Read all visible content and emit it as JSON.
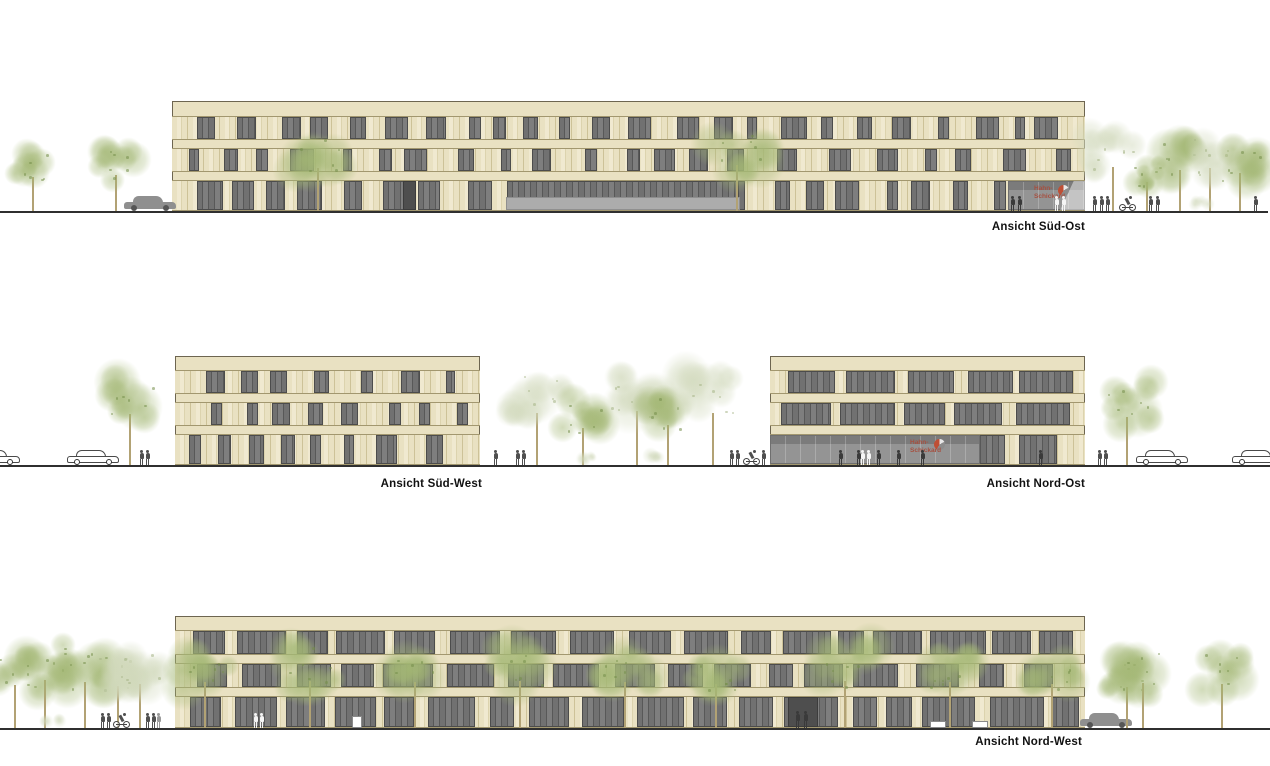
{
  "palette": {
    "background": "#ffffff",
    "wall": "#e9e1c2",
    "wall_stripe_light": "#f0e9d0",
    "wall_stripe_dark": "#dcd3ae",
    "wall_joint": "#cdc298",
    "facade_line": "#a2976f",
    "building_outline": "#6d6550",
    "window_glass": "#717171",
    "window_glass_dark": "#585858",
    "window_glass_light": "#7e7e7e",
    "window_outline": "#4c4c4c",
    "storefront_grey": "#949494",
    "storefront_top": "#7b7b7b",
    "canopy_grey": "#acacac",
    "door_dark": "#4e4e4e",
    "ground_line": "#2f2f2f",
    "figure_grey": "#4f4f4f",
    "figure_dark": "#3a3a3a",
    "figure_white": "#f5f5f5",
    "figure_light": "#9a9a9a",
    "car_outline": "#4a4a4a",
    "car_fill": "#8f8f8f",
    "trunk": "#b2a274",
    "tree_green": [
      163,
      183,
      116
    ],
    "tree_green_dark": [
      116,
      142,
      74
    ],
    "tree_pale": [
      208,
      216,
      186
    ],
    "tree_pale_dark": [
      165,
      180,
      135
    ],
    "logo_red": "#bf4f35",
    "logo_grey": "#8c8c8c",
    "logo_text_color": "#a65040"
  },
  "logo": {
    "line1": "Hahn-",
    "line2": "Schickard"
  },
  "views": {
    "sued_ost": {
      "label": "Ansicht Süd-Ost",
      "ground": {
        "y": 211,
        "x1": 0,
        "x2": 1268
      },
      "building": {
        "x": 172,
        "y": 101,
        "w": 913,
        "parapet_h": 15,
        "band_h": 8,
        "floors": [
          {
            "h": 24,
            "pattern": {
              "edge": 10,
              "gap": [
                8,
                30
              ],
              "win": [
                9,
                26
              ],
              "seed": 11
            }
          },
          {
            "h": 24,
            "pattern": {
              "edge": 14,
              "gap": [
                10,
                34
              ],
              "win": [
                9,
                24
              ],
              "seed": 23
            }
          },
          {
            "h": 31,
            "pattern": {
              "edge": 10,
              "gap": [
                8,
                30
              ],
              "win": [
                9,
                26
              ],
              "seed": 37
            },
            "overlays": [
              {
                "type": "glass",
                "x": 335,
                "w": 232
              },
              {
                "type": "door",
                "x": 231,
                "w": 13
              },
              {
                "type": "storefront",
                "x": 836,
                "w": 77,
                "logo": true,
                "logo_left": 26,
                "diagonal": true,
                "top_band": true
              },
              {
                "type": "canopy",
                "x": 334,
                "w": 234,
                "h": 13
              }
            ]
          }
        ]
      },
      "trees": [
        {
          "x": 33,
          "h": 62,
          "s": 34,
          "tone": "green",
          "seed": 1
        },
        {
          "x": 116,
          "h": 66,
          "s": 38,
          "tone": "green",
          "seed": 2
        },
        {
          "x": 318,
          "h": 78,
          "s": 46,
          "tone": "green",
          "seed": 3
        },
        {
          "x": 737,
          "h": 84,
          "s": 50,
          "tone": "green",
          "seed": 4
        },
        {
          "x": 1113,
          "h": 80,
          "s": 46,
          "tone": "pale",
          "seed": 5
        },
        {
          "x": 1147,
          "h": 52,
          "s": 30,
          "tone": "green",
          "seed": 6
        },
        {
          "x": 1180,
          "h": 74,
          "s": 46,
          "tone": "green",
          "seed": 7
        },
        {
          "x": 1210,
          "h": 78,
          "s": 46,
          "tone": "pale",
          "seed": 8
        },
        {
          "x": 1240,
          "h": 70,
          "s": 44,
          "tone": "green",
          "seed": 9
        }
      ],
      "bushes": [
        {
          "x": 1200,
          "s": 16,
          "seed": 10
        }
      ],
      "cars": [
        {
          "x": 150,
          "style": "solid"
        }
      ],
      "bikes": [
        {
          "x": 1128
        }
      ],
      "figures": [
        {
          "x": 1094
        },
        {
          "x": 1101
        },
        {
          "x": 1107
        },
        {
          "x": 1150
        },
        {
          "x": 1157
        },
        {
          "x": 1255
        },
        {
          "x": 1012,
          "color": "dark"
        },
        {
          "x": 1019,
          "color": "dark"
        },
        {
          "x": 1056,
          "color": "white"
        },
        {
          "x": 1063,
          "color": "white"
        }
      ],
      "boxes": []
    },
    "sued_west": {
      "label": "Ansicht Süd-West",
      "ground": {
        "y": 465,
        "x1": 0,
        "x2": 770
      },
      "building": {
        "x": 175,
        "y": 356,
        "w": 305,
        "parapet_h": 14,
        "band_h": 8,
        "floors": [
          {
            "h": 24,
            "pattern": {
              "edge": 8,
              "gap": [
                10,
                34
              ],
              "win": [
                9,
                22
              ],
              "seed": 5
            }
          },
          {
            "h": 24,
            "pattern": {
              "edge": 12,
              "gap": [
                12,
                36
              ],
              "win": [
                9,
                20
              ],
              "seed": 17
            }
          },
          {
            "h": 31,
            "pattern": {
              "edge": 8,
              "gap": [
                10,
                30
              ],
              "win": [
                10,
                24
              ],
              "seed": 29
            }
          }
        ]
      },
      "trees": [
        {
          "x": 130,
          "h": 92,
          "s": 52,
          "tone": "green",
          "seed": 11
        },
        {
          "x": 537,
          "h": 95,
          "s": 56,
          "tone": "pale",
          "seed": 12
        },
        {
          "x": 583,
          "h": 68,
          "s": 40,
          "tone": "green",
          "seed": 13
        },
        {
          "x": 637,
          "h": 98,
          "s": 58,
          "tone": "pale",
          "seed": 14
        },
        {
          "x": 668,
          "h": 72,
          "s": 42,
          "tone": "green",
          "seed": 15
        },
        {
          "x": 713,
          "h": 95,
          "s": 56,
          "tone": "pale",
          "seed": 16
        }
      ],
      "bushes": [
        {
          "x": 590,
          "s": 15,
          "seed": 17
        },
        {
          "x": 657,
          "s": 15,
          "seed": 18
        }
      ],
      "cars": [
        {
          "x": -6,
          "style": "outline"
        },
        {
          "x": 93,
          "style": "outline"
        }
      ],
      "bikes": [
        {
          "x": 752
        }
      ],
      "figures": [
        {
          "x": 141
        },
        {
          "x": 147
        },
        {
          "x": 495
        },
        {
          "x": 517
        },
        {
          "x": 523
        },
        {
          "x": 731
        },
        {
          "x": 737
        },
        {
          "x": 763
        }
      ],
      "boxes": []
    },
    "nord_ost": {
      "label": "Ansicht Nord-Ost",
      "ground": {
        "y": 465,
        "x1": 770,
        "x2": 1270
      },
      "building": {
        "x": 770,
        "y": 356,
        "w": 315,
        "parapet_h": 14,
        "band_h": 8,
        "floors": [
          {
            "h": 24,
            "pattern": {
              "edge": 6,
              "gap": [
                6,
                14
              ],
              "win": [
                30,
                64
              ],
              "seed": 41
            }
          },
          {
            "h": 24,
            "pattern": {
              "edge": 10,
              "gap": [
                8,
                18
              ],
              "win": [
                24,
                56
              ],
              "seed": 53
            }
          },
          {
            "h": 31,
            "pattern": {
              "edge": 6,
              "gap": [
                6,
                16
              ],
              "win": [
                22,
                48
              ],
              "seed": 61
            },
            "overlays": [
              {
                "type": "storefront",
                "x": 0,
                "w": 210,
                "logo": true,
                "logo_left": 140,
                "top_band": true
              }
            ]
          }
        ]
      },
      "trees": [
        {
          "x": 1127,
          "h": 88,
          "s": 52,
          "tone": "green",
          "seed": 21
        }
      ],
      "bushes": [],
      "cars": [
        {
          "x": 1162,
          "style": "outline"
        },
        {
          "x": 1258,
          "style": "outline"
        }
      ],
      "bikes": [],
      "figures": [
        {
          "x": 840,
          "color": "dark"
        },
        {
          "x": 858,
          "color": "dark"
        },
        {
          "x": 878,
          "color": "dark"
        },
        {
          "x": 898,
          "color": "dark"
        },
        {
          "x": 922,
          "color": "dark"
        },
        {
          "x": 862,
          "color": "white"
        },
        {
          "x": 868,
          "color": "white"
        },
        {
          "x": 1040,
          "color": "dark"
        },
        {
          "x": 1099
        },
        {
          "x": 1105
        }
      ],
      "boxes": []
    },
    "nord_west": {
      "label": "Ansicht Nord-West",
      "ground": {
        "y": 728,
        "x1": 0,
        "x2": 1270
      },
      "building": {
        "x": 175,
        "y": 616,
        "w": 910,
        "parapet_h": 14,
        "band_h": 8,
        "floors": [
          {
            "h": 25,
            "pattern": {
              "edge": 6,
              "gap": [
                6,
                16
              ],
              "win": [
                26,
                60
              ],
              "seed": 71
            }
          },
          {
            "h": 25,
            "pattern": {
              "edge": 8,
              "gap": [
                8,
                20
              ],
              "win": [
                22,
                52
              ],
              "seed": 83
            }
          },
          {
            "h": 32,
            "pattern": {
              "edge": 6,
              "gap": [
                6,
                16
              ],
              "win": [
                24,
                56
              ],
              "seed": 97
            },
            "overlays": [
              {
                "type": "door",
                "x": 613,
                "w": 30
              }
            ]
          }
        ]
      },
      "trees": [
        {
          "x": 15,
          "h": 78,
          "s": 46,
          "tone": "green",
          "seed": 31
        },
        {
          "x": 45,
          "h": 88,
          "s": 52,
          "tone": "green",
          "seed": 32
        },
        {
          "x": 85,
          "h": 84,
          "s": 50,
          "tone": "green",
          "seed": 33
        },
        {
          "x": 118,
          "h": 76,
          "s": 44,
          "tone": "pale",
          "seed": 34
        },
        {
          "x": 140,
          "h": 80,
          "s": 46,
          "tone": "pale",
          "seed": 35
        },
        {
          "x": 205,
          "h": 84,
          "s": 48,
          "tone": "green",
          "seed": 36
        },
        {
          "x": 310,
          "h": 86,
          "s": 50,
          "tone": "green",
          "seed": 37
        },
        {
          "x": 415,
          "h": 84,
          "s": 48,
          "tone": "green",
          "seed": 38
        },
        {
          "x": 520,
          "h": 86,
          "s": 50,
          "tone": "green",
          "seed": 39
        },
        {
          "x": 625,
          "h": 84,
          "s": 48,
          "tone": "green",
          "seed": 40
        },
        {
          "x": 716,
          "h": 80,
          "s": 46,
          "tone": "green",
          "seed": 41
        },
        {
          "x": 845,
          "h": 86,
          "s": 50,
          "tone": "green",
          "seed": 42
        },
        {
          "x": 950,
          "h": 84,
          "s": 48,
          "tone": "green",
          "seed": 43
        },
        {
          "x": 1052,
          "h": 80,
          "s": 46,
          "tone": "green",
          "seed": 44
        },
        {
          "x": 1127,
          "h": 74,
          "s": 44,
          "tone": "green",
          "seed": 45
        },
        {
          "x": 1143,
          "h": 82,
          "s": 48,
          "tone": "green",
          "seed": 46
        },
        {
          "x": 1222,
          "h": 80,
          "s": 46,
          "tone": "green",
          "seed": 47
        }
      ],
      "bushes": [
        {
          "x": 52,
          "s": 16,
          "seed": 48
        }
      ],
      "cars": [
        {
          "x": 1106,
          "style": "solid"
        }
      ],
      "bikes": [
        {
          "x": 122
        }
      ],
      "figures": [
        {
          "x": 102
        },
        {
          "x": 108
        },
        {
          "x": 147
        },
        {
          "x": 153
        },
        {
          "x": 158,
          "color": "light"
        },
        {
          "x": 255,
          "color": "white"
        },
        {
          "x": 261,
          "color": "white"
        },
        {
          "x": 797,
          "color": "dark",
          "h": 17
        },
        {
          "x": 805,
          "color": "dark",
          "h": 17
        }
      ],
      "boxes": [
        {
          "x": 352,
          "w": 10,
          "h": 12
        },
        {
          "x": 930,
          "w": 16,
          "h": 7
        },
        {
          "x": 972,
          "w": 16,
          "h": 7
        }
      ]
    }
  }
}
